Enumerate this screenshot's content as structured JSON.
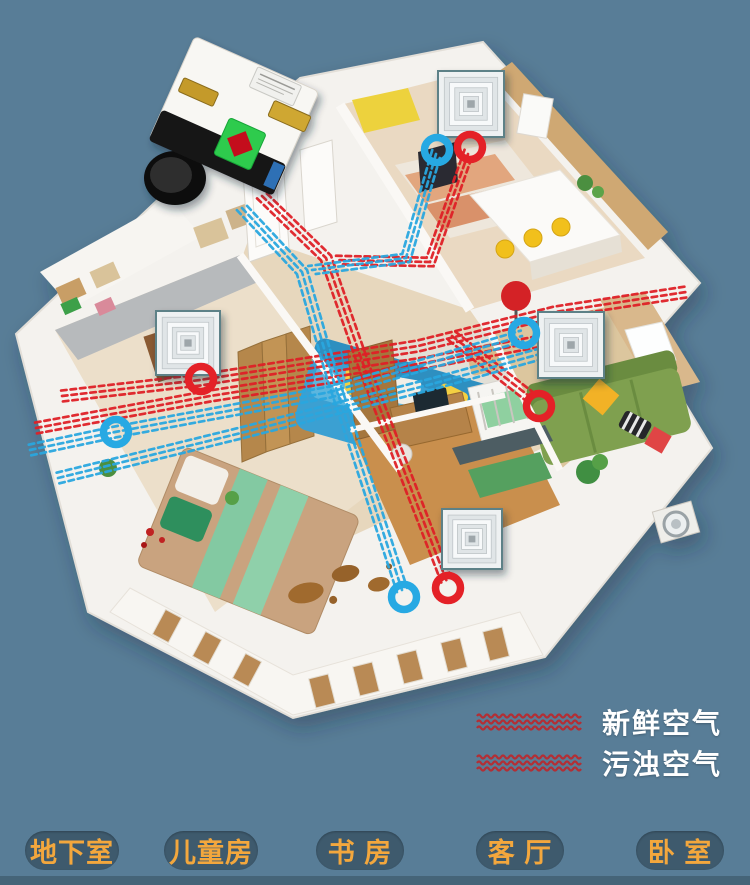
{
  "legend": {
    "items": [
      {
        "label": "新鲜空气",
        "swatch": "wavy-lines",
        "swatch_color": "#b22f35"
      },
      {
        "label": "污浊空气",
        "swatch": "wavy-lines",
        "swatch_color": "#b22f35"
      }
    ],
    "text_color": "#ffffff"
  },
  "room_buttons": [
    {
      "label": "地下室"
    },
    {
      "label": "儿童房"
    },
    {
      "label": "书 房"
    },
    {
      "label": "客 厅"
    },
    {
      "label": "卧 室"
    }
  ],
  "colors": {
    "background": "#587d97",
    "button_bg": "#3e5a6d",
    "button_text": "#f3a73d",
    "bottom_strip": "#456478",
    "duct_red": "#de2026",
    "duct_blue": "#29a7de",
    "ring_red": "#e42127",
    "ring_blue": "#27a9e3",
    "diffuser_border": "#5d8187"
  },
  "diagram": {
    "diffusers": [
      {
        "name": "diffuser-kitchen",
        "x": 471,
        "y": 104,
        "size": 58
      },
      {
        "name": "diffuser-left-bedroom",
        "x": 188,
        "y": 343,
        "size": 56
      },
      {
        "name": "diffuser-right-bedroom",
        "x": 571,
        "y": 345,
        "size": 58
      },
      {
        "name": "diffuser-study",
        "x": 472,
        "y": 539,
        "size": 52
      }
    ],
    "vent_rings": [
      {
        "name": "kitchen-supply-ring",
        "x": 437,
        "y": 150,
        "color": "blue"
      },
      {
        "name": "kitchen-return-ring",
        "x": 470,
        "y": 147,
        "color": "red"
      },
      {
        "name": "left-bedroom-return-ring",
        "x": 201,
        "y": 379,
        "color": "red"
      },
      {
        "name": "left-bedroom-supply-ring",
        "x": 116,
        "y": 432,
        "color": "blue"
      },
      {
        "name": "right-bedroom-supply-ring",
        "x": 524,
        "y": 333,
        "color": "blue"
      },
      {
        "name": "right-bedroom-return-ring",
        "x": 539,
        "y": 406,
        "color": "red"
      },
      {
        "name": "study-supply-ring",
        "x": 404,
        "y": 597,
        "color": "blue"
      },
      {
        "name": "study-return-ring",
        "x": 448,
        "y": 588,
        "color": "red"
      }
    ],
    "duct_routes": [
      {
        "name": "red-trunk-to-study-vent",
        "color": "red",
        "points": [
          [
            262,
            196
          ],
          [
            326,
            258
          ],
          [
            366,
            372
          ],
          [
            447,
            582
          ]
        ]
      },
      {
        "name": "red-branch-to-kitchen-vent",
        "color": "red",
        "points": [
          [
            468,
            154
          ],
          [
            430,
            262
          ],
          [
            336,
            260
          ]
        ]
      },
      {
        "name": "red-cross-left-to-right",
        "color": "red",
        "points": [
          [
            62,
            396
          ],
          [
            200,
            380
          ],
          [
            418,
            346
          ],
          [
            555,
            312
          ],
          [
            686,
            292
          ]
        ]
      },
      {
        "name": "red-cross-2",
        "color": "red",
        "points": [
          [
            36,
            428
          ],
          [
            210,
            396
          ],
          [
            430,
            362
          ],
          [
            600,
            330
          ]
        ]
      },
      {
        "name": "red-branch-to-right-vent",
        "color": "red",
        "points": [
          [
            452,
            336
          ],
          [
            534,
            400
          ]
        ]
      },
      {
        "name": "blue-trunk-to-study-vent",
        "color": "blue",
        "points": [
          [
            242,
            208
          ],
          [
            302,
            272
          ],
          [
            332,
            376
          ],
          [
            402,
            590
          ]
        ]
      },
      {
        "name": "blue-branch-to-kitchen-vent",
        "color": "blue",
        "points": [
          [
            436,
            154
          ],
          [
            406,
            258
          ],
          [
            312,
            270
          ]
        ]
      },
      {
        "name": "blue-cross-left-to-right",
        "color": "blue",
        "points": [
          [
            30,
            450
          ],
          [
            115,
            432
          ],
          [
            330,
            392
          ],
          [
            522,
            336
          ]
        ]
      },
      {
        "name": "blue-cross-2",
        "color": "blue",
        "points": [
          [
            58,
            478
          ],
          [
            245,
            432
          ],
          [
            432,
            384
          ],
          [
            540,
            354
          ]
        ]
      }
    ]
  }
}
